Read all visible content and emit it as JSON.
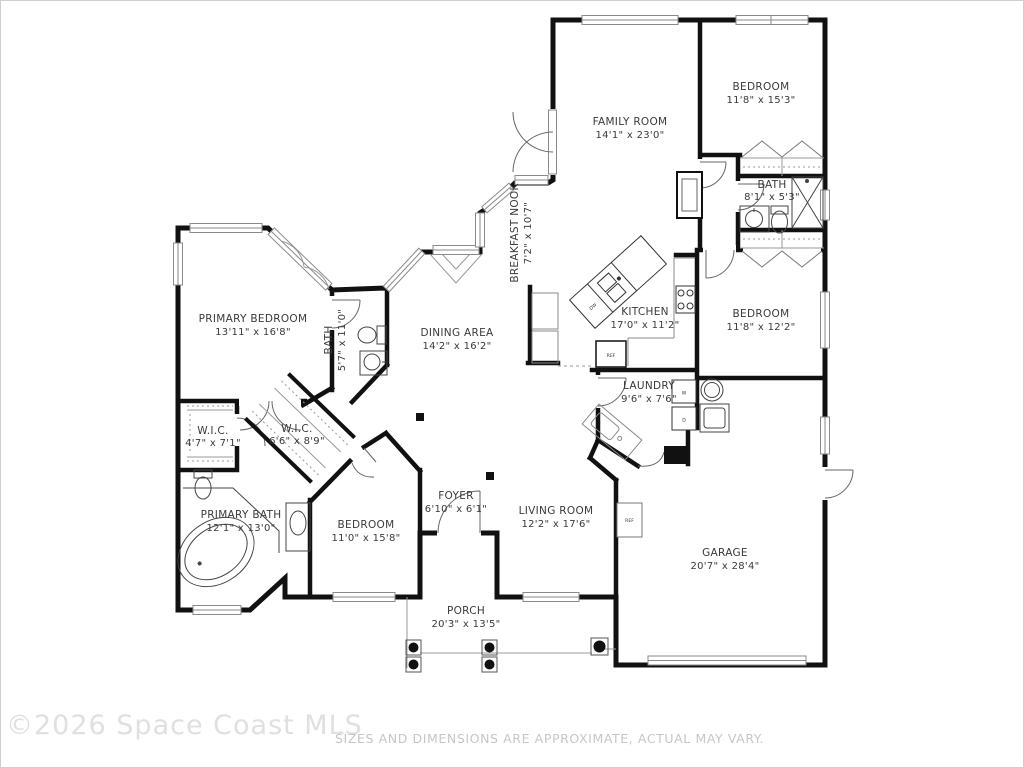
{
  "floor_plan": {
    "rooms": [
      {
        "name": "FAMILY ROOM",
        "dims": "14'1\" x 23'0\""
      },
      {
        "name": "BEDROOM",
        "dims": "11'8\" x 15'3\""
      },
      {
        "name": "BATH",
        "dims": "8'1\" x 5'3\""
      },
      {
        "name": "BEDROOM",
        "dims": "11'8\" x 12'2\""
      },
      {
        "name": "KITCHEN",
        "dims": "17'0\" x 11'2\""
      },
      {
        "name": "LAUNDRY",
        "dims": "9'6\" x 7'6\""
      },
      {
        "name": "BREAKFAST NOOK",
        "dims": "7'2\" x 10'7\""
      },
      {
        "name": "DINING AREA",
        "dims": "14'2\" x 16'2\""
      },
      {
        "name": "PRIMARY BEDROOM",
        "dims": "13'11\" x 16'8\""
      },
      {
        "name": "BATH",
        "dims": "5'7\" x 11'0\""
      },
      {
        "name": "W.I.C.",
        "dims": "4'7\" x 7'1\""
      },
      {
        "name": "W.I.C.",
        "dims": "6'6\" x 8'9\""
      },
      {
        "name": "PRIMARY BATH",
        "dims": "12'1\" x 13'0\""
      },
      {
        "name": "BEDROOM",
        "dims": "11'0\" x 15'8\""
      },
      {
        "name": "FOYER",
        "dims": "6'10\" x 6'1\""
      },
      {
        "name": "LIVING ROOM",
        "dims": "12'2\" x 17'6\""
      },
      {
        "name": "GARAGE",
        "dims": "20'7\" x 28'4\""
      },
      {
        "name": "PORCH",
        "dims": "20'3\" x 13'5\""
      }
    ],
    "fixtures": {
      "dishwasher": "DW",
      "refrigerator": "REF",
      "garage_refrigerator": "REF",
      "washer": "W",
      "dryer": "D"
    },
    "colors": {
      "wall": "#111111",
      "thin_line": "#8a8a8a",
      "label": "#3a3a3a",
      "watermark": "#e0e0e0",
      "disclaimer": "#c6c6ca"
    }
  },
  "footer": {
    "copyright": "©2026 Space Coast MLS",
    "disclaimer": "SIZES AND DIMENSIONS ARE APPROXIMATE, ACTUAL MAY VARY."
  }
}
